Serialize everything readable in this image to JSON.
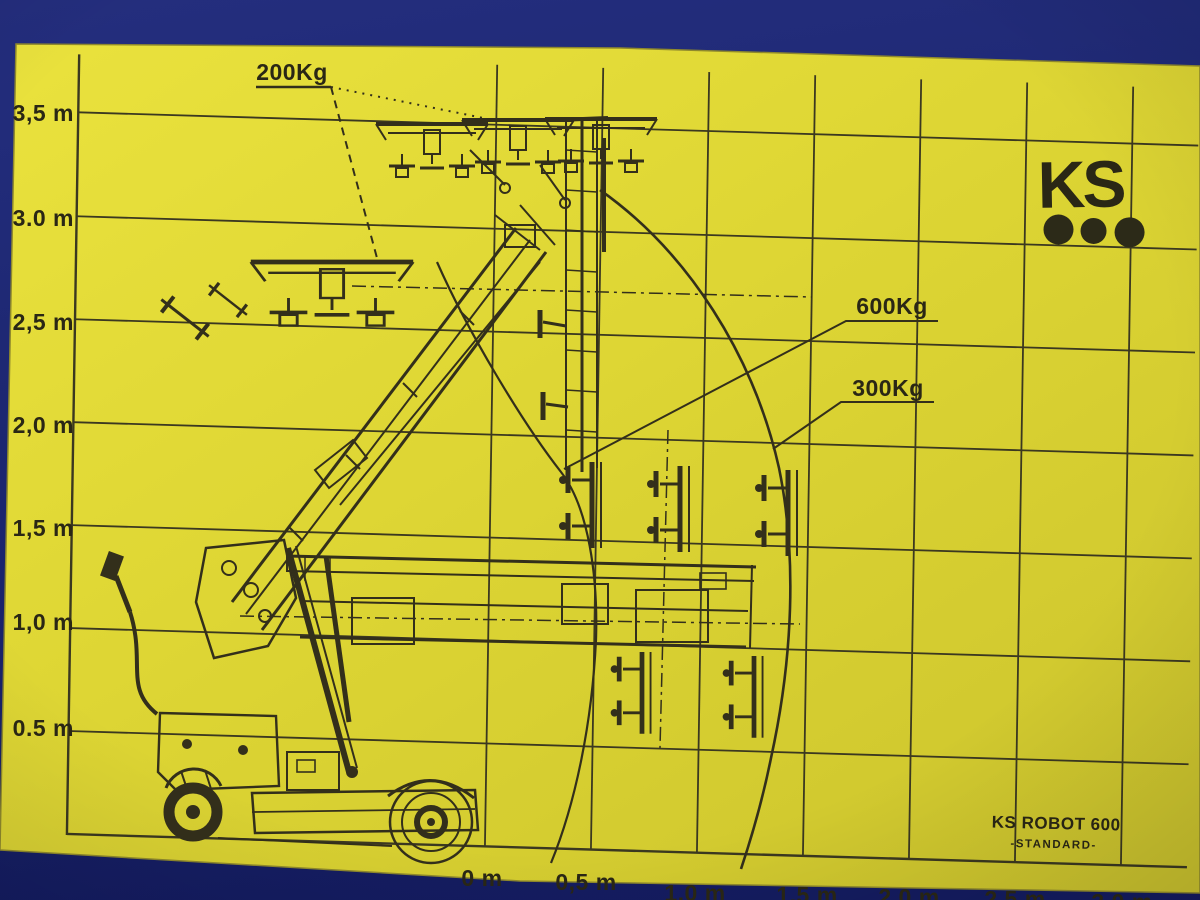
{
  "logo": {
    "text": "KS"
  },
  "model": {
    "name": "KS ROBOT 600",
    "variant": "-STANDARD-"
  },
  "capacity_labels": {
    "top": "200Kg",
    "inner": "600Kg",
    "outer": "300Kg"
  },
  "y_axis": {
    "ticks": [
      "3,5 m",
      "3.0 m",
      "2,5 m",
      "2,0 m",
      "1,5 m",
      "1,0 m",
      "0.5 m"
    ]
  },
  "x_axis": {
    "ticks": [
      "0 m",
      "0,5 m",
      "1,0 m",
      "1,5 m",
      "2,0 m",
      "2,5 m",
      "3,0 m"
    ]
  },
  "colors": {
    "paper": "#ddd535",
    "background_blue": "#1d2775",
    "ink": "#332f1b"
  },
  "chart_data": {
    "type": "line",
    "title": "KS ROBOT 600 -STANDARD- load capacity diagram",
    "xlabel": "horizontal reach (m)",
    "ylabel": "lifting height (m)",
    "x_ticks_m": [
      0,
      0.5,
      1.0,
      1.5,
      2.0,
      2.5,
      3.0
    ],
    "y_ticks_m": [
      0.5,
      1.0,
      1.5,
      2.0,
      2.5,
      3.0,
      3.5
    ],
    "series": [
      {
        "name": "200Kg",
        "note": "maximum height positions, approx 2.5 m - 3.5 m lift shown at top of mast"
      },
      {
        "name": "600Kg",
        "note": "inner reach curve, approx 0.5 m radius envelope"
      },
      {
        "name": "300Kg",
        "note": "outer reach curve, approx 1.3 m radius envelope"
      }
    ],
    "legend_position": "labels with leader lines inside plot",
    "grid": true
  }
}
